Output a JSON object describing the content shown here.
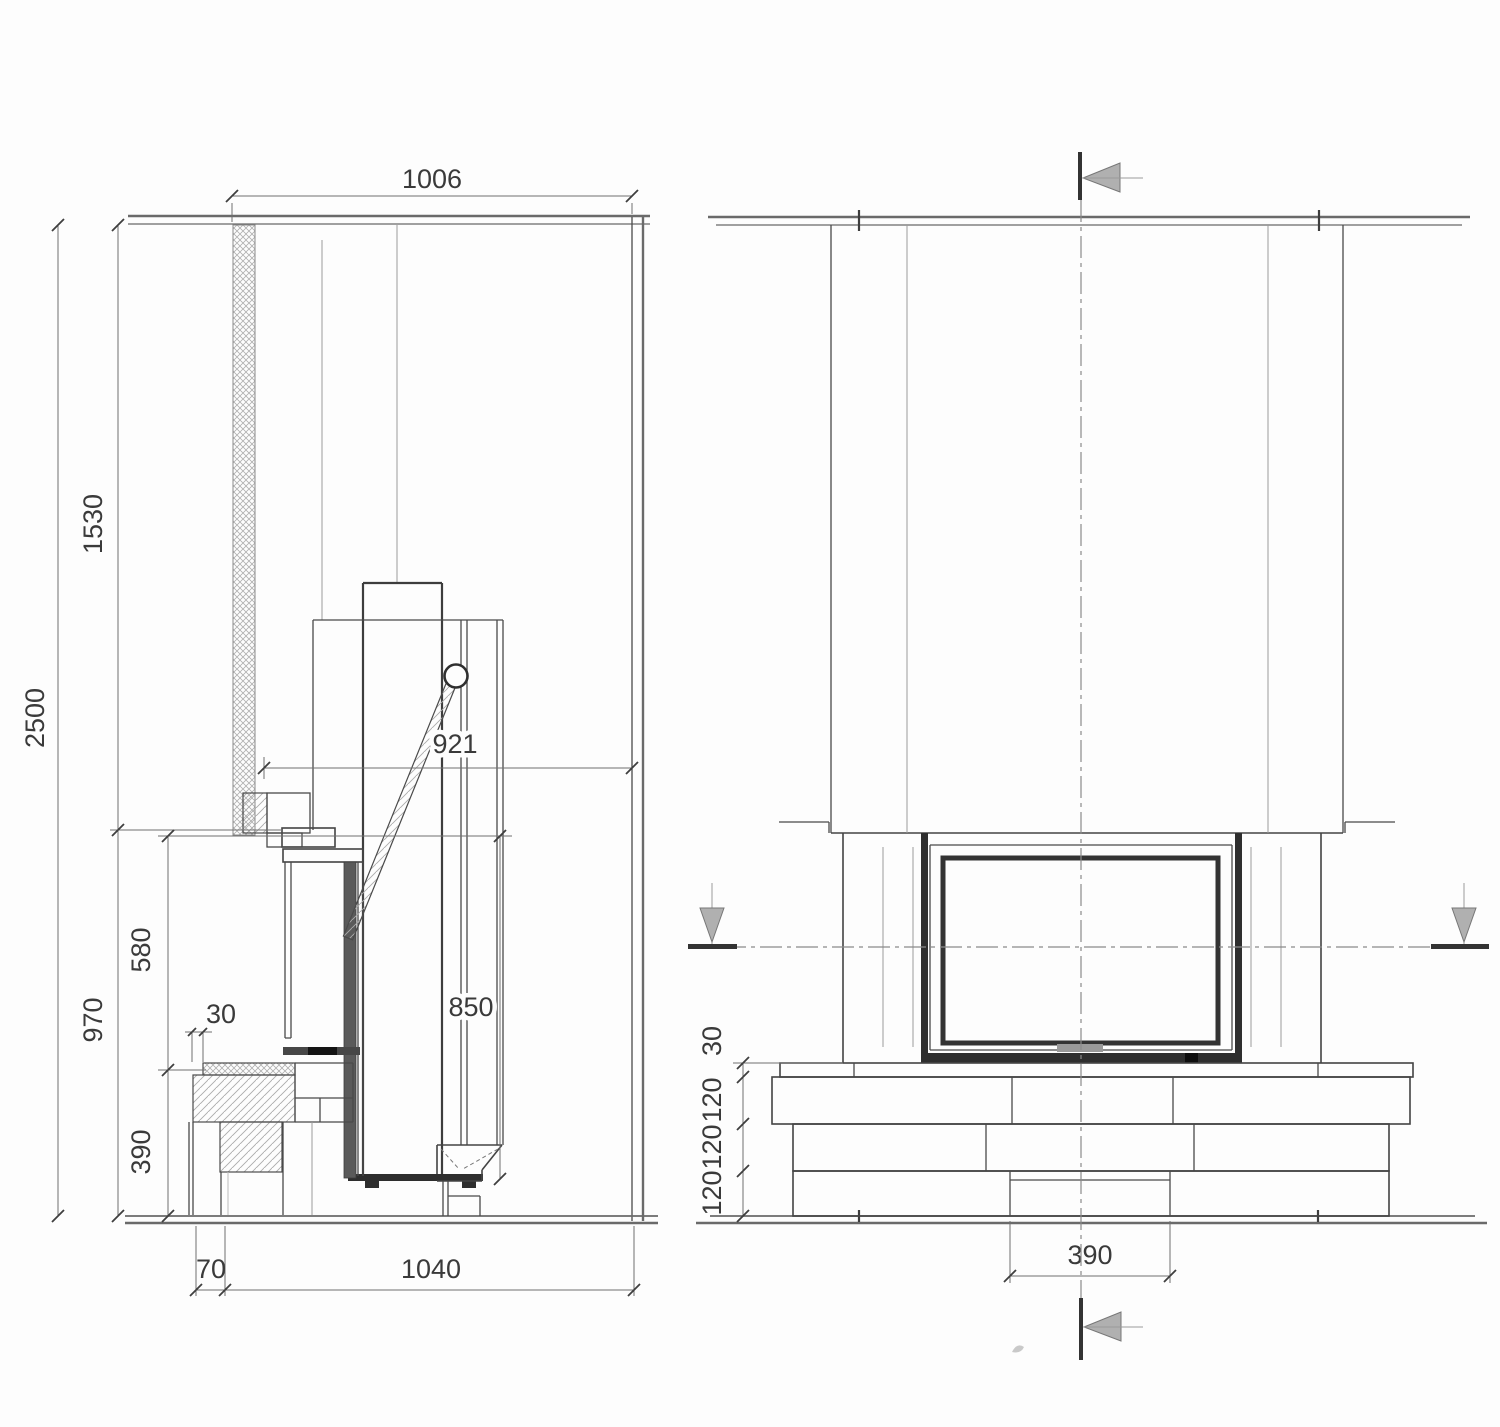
{
  "side_view": {
    "dim_wall_opening_width": "1006",
    "dim_total_height": "2500",
    "dim_upper_height": "1530",
    "dim_lower_height": "970",
    "dim_firebox_height": "580",
    "dim_bench_height": "390",
    "dim_wall_gap": "30",
    "dim_depth": "921",
    "dim_opening_height": "850",
    "dim_bench_offset": "70",
    "dim_total_depth": "1040"
  },
  "front_view": {
    "dim_hearth_top": "30",
    "dim_hearth_layer1": "120",
    "dim_hearth_layer2": "120",
    "dim_hearth_layer3": "120",
    "dim_flue_width": "390"
  },
  "colors": {
    "line": "#3f3f3f",
    "line_light": "#9a9a9a",
    "fill_dark": "#2e2e2e",
    "fill_gray": "#9a9a9a",
    "hatch": "#b0b0b0"
  }
}
